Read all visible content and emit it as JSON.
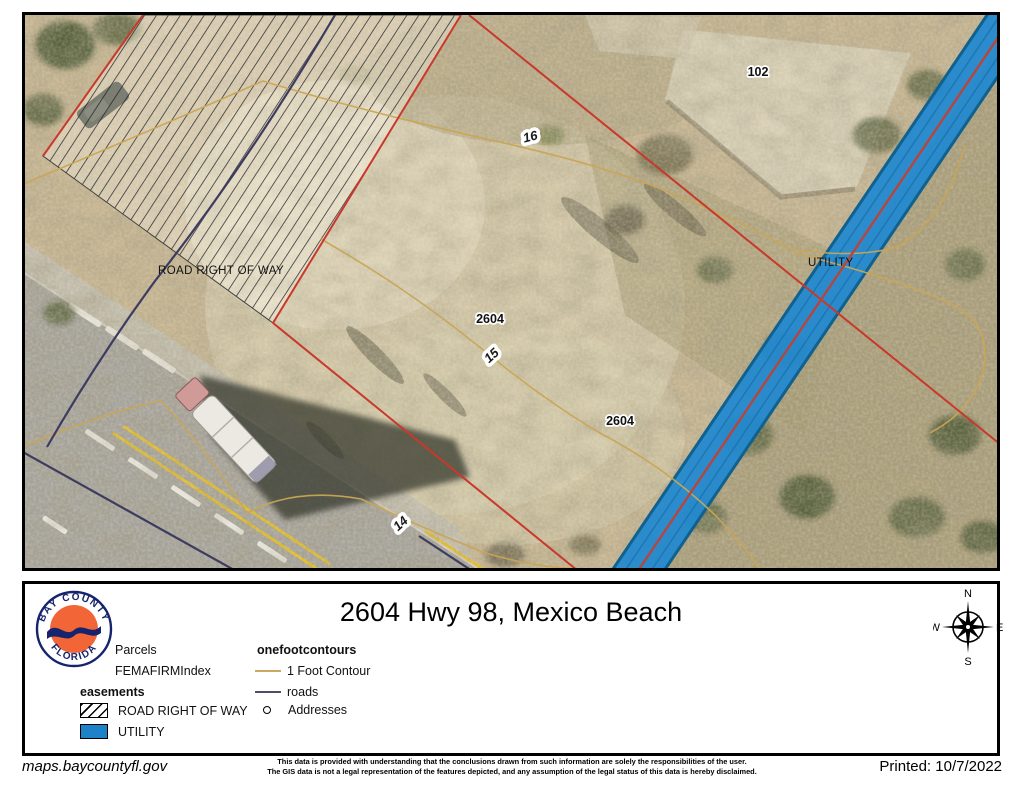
{
  "map": {
    "labels": {
      "parcel_102": "102",
      "parcel_2604_upper": "2604",
      "parcel_2604_lower": "2604",
      "contour_16": "16",
      "contour_15": "15",
      "contour_14": "14",
      "road_right_of_way": "ROAD RIGHT OF WAY",
      "utility": "UTILITY"
    }
  },
  "legend": {
    "title": "2604 Hwy 98, Mexico Beach",
    "logo_top": "BAY COUNTY",
    "logo_bottom": "FLORIDA",
    "compass": {
      "n": "N",
      "e": "E",
      "s": "S",
      "w": "W"
    },
    "parcels": "Parcels",
    "femafirm": "FEMAFIRMIndex",
    "easements": "easements",
    "road_right_of_way": "ROAD RIGHT OF WAY",
    "utility": "UTILITY",
    "onefootcontours": "onefootcontours",
    "one_foot_contour": "1 Foot Contour",
    "roads": "roads",
    "addresses": "Addresses"
  },
  "footer": {
    "site": "maps.baycountyfl.gov",
    "disclaimer_line1": "This data is provided with understanding that the conclusions drawn from such information are solely the responsibilities of the user.",
    "disclaimer_line2": "The GIS data is not a legal representation of the features depicted, and any assumption of the legal status of this data is hereby disclaimed.",
    "printed": "Printed: 10/7/2022"
  },
  "colors": {
    "utility_blue": "#1e82c8",
    "parcel_red": "#c8392b",
    "contour_tan": "#c9a555",
    "roads_navy": "#3d3c60",
    "logo_orange": "#f26537",
    "logo_navy": "#16246e"
  }
}
